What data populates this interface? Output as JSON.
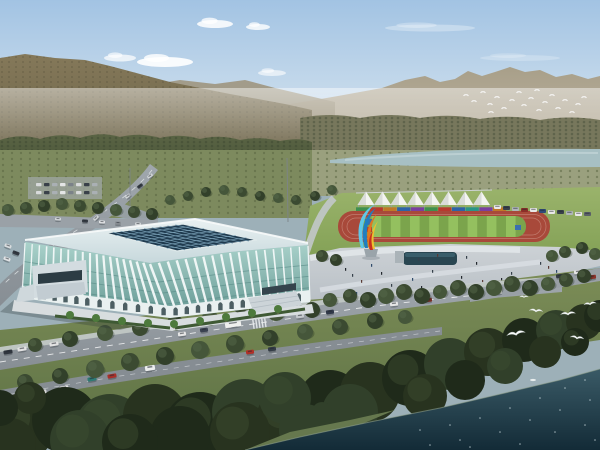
{
  "palette": {
    "sky_top": "#a2c3e3",
    "sky_mid": "#c9dcec",
    "sky_horizon": "#edf0ec",
    "cloud": "#ffffff",
    "far_mountain_top": "#a89f89",
    "far_mountain_bottom": "#beb5a3",
    "left_mountain_top": "#85795a",
    "left_mountain_bottom": "#6b6247",
    "ridge_mid": "#9f967f",
    "tree_belt_top": "#5a6444",
    "tree_belt_bottom": "#465136",
    "right_forest": "#77775c",
    "orchard_band": "#7d8a5e",
    "valley_band": "#9aa07e",
    "river": "#a7c0c4",
    "river_highlight": "#c3d6d8",
    "lawn_top": "#9ab36b",
    "lawn_bottom": "#82a055",
    "track_red": "#a8493a",
    "lane_line": "#c88a7c",
    "infield_base": "#7ba44c",
    "infield_stripe": "#94c05f",
    "mat_blue": "#3a6fb0",
    "mat_red": "#b83a2e",
    "tent_white": "#f3f4f1",
    "tent_shade": "#d9dcd8",
    "plaza_top": "#cdd2d6",
    "plaza_bottom": "#b7bec4",
    "pool_dark": "#294651",
    "pool_light": "#3d6472",
    "road_light": "#a0a7ad",
    "road_dark": "#878e94",
    "sidewalk": "#c7ccce",
    "lane_dash": "#eef0f1",
    "grass_top": "#7c8d57",
    "grass_bottom": "#5c7044",
    "roof_top": "#e9f1f2",
    "roof_bottom": "#c7d8dc",
    "roof_trim": "#f8fbfb",
    "skylight": "#1f3a4e",
    "skylight_grid": "#7fa6bc",
    "facade_glass_top": "#aad2cb",
    "facade_glass_bottom": "#649792",
    "facade_rib": "#f4f9f9",
    "facade_floor": "#5d8f8a",
    "arcade_band": "#e9f0f0",
    "arch_dark": "#31454a",
    "annex_grey": "#d3dce0",
    "annex_glass": "#2c3c44",
    "apron": "#d8dddf",
    "hedge": "#3f5a34",
    "palm": "#4d7a3c",
    "water_top": "#3a5a66",
    "water_bottom": "#132b37",
    "sparkle": "#d6e4e8",
    "bird_white": "#fafafa",
    "gull_white": "#f7f9f9",
    "sculpture_cyan": "#5fc8e8",
    "sculpture_blue": "#1f7ec0",
    "sculpture_orange": "#e07820",
    "sculpture_yellow": "#ecc030",
    "sculpture_red": "#c83020",
    "pedestal": "#9aa4aa",
    "tree_tones": [
      "#3b4a31",
      "#32402a",
      "#45563a"
    ],
    "fg_tree_tones": [
      "#28331f",
      "#1f2a1a",
      "#31402a"
    ],
    "ped_tones": [
      "#23282e",
      "#35404a",
      "#5a3a34",
      "#2e4a6a"
    ]
  },
  "scene": {
    "clouds": [
      [
        165,
        62,
        28,
        5,
        0.9
      ],
      [
        215,
        24,
        18,
        4,
        0.85
      ],
      [
        258,
        27,
        12,
        3,
        0.8
      ],
      [
        272,
        73,
        14,
        3,
        0.6
      ],
      [
        430,
        28,
        45,
        3.5,
        0.3
      ],
      [
        520,
        58,
        40,
        3,
        0.22
      ],
      [
        120,
        58,
        16,
        3.5,
        0.7
      ]
    ],
    "far_birds": [
      [
        466,
        95
      ],
      [
        474,
        101
      ],
      [
        483,
        92
      ],
      [
        490,
        104
      ],
      [
        497,
        97
      ],
      [
        504,
        108
      ],
      [
        512,
        100
      ],
      [
        519,
        92
      ],
      [
        524,
        105
      ],
      [
        531,
        98
      ],
      [
        539,
        110
      ],
      [
        545,
        102
      ],
      [
        552,
        95
      ],
      [
        558,
        108
      ],
      [
        565,
        100
      ],
      [
        572,
        112
      ],
      [
        578,
        104
      ],
      [
        584,
        97
      ],
      [
        491,
        112
      ],
      [
        537,
        90
      ]
    ],
    "gulls": [
      [
        516,
        334,
        15,
        -10
      ],
      [
        536,
        311,
        11,
        5
      ],
      [
        568,
        314,
        12,
        -5
      ],
      [
        577,
        338,
        11,
        8
      ],
      [
        590,
        304,
        10,
        -8
      ],
      [
        524,
        297,
        7,
        0
      ]
    ],
    "tents": {
      "x0": 366,
      "dx": 16.5,
      "n": 8,
      "apex": 191.5,
      "base": 205,
      "half": 8.5
    },
    "banner_panels": [
      "#3f8f4f",
      "#b8392e",
      "#c07828",
      "#2e62a8",
      "#7a3fa0",
      "#3f8f4f",
      "#b8392e",
      "#2e62a8",
      "#2a9488",
      "#7a3fa0",
      "#c07828"
    ],
    "track": {
      "outer": [
        338,
        211,
        212,
        31,
        15
      ],
      "infield": [
        362,
        216,
        164,
        21,
        10
      ],
      "stripe_w": 9.6,
      "stripe_n": 17
    },
    "parked_cars": [
      [
        494,
        205,
        "#e8e8e8"
      ],
      [
        503,
        206,
        "#38404a"
      ],
      [
        512,
        207,
        "#b0b6ba"
      ],
      [
        521,
        208,
        "#8a2f28"
      ],
      [
        530,
        208,
        "#e8e8e8"
      ],
      [
        539,
        209,
        "#2f4a78"
      ],
      [
        548,
        210,
        "#e8e8e8"
      ],
      [
        557,
        210,
        "#38404a"
      ],
      [
        566,
        211,
        "#b0b6ba"
      ],
      [
        575,
        212,
        "#e8e8e8"
      ],
      [
        584,
        212,
        "#5a6068"
      ]
    ],
    "cars": [
      [
        233,
        324,
        16,
        6,
        -8,
        "#f0f0ee"
      ],
      [
        182,
        334,
        8,
        4,
        -8,
        "#e6e6e6"
      ],
      [
        204,
        330,
        8,
        4,
        -8,
        "#3a4250"
      ],
      [
        300,
        316,
        8,
        4,
        -7,
        "#c4c8cc"
      ],
      [
        330,
        312,
        8,
        4,
        -7,
        "#303848"
      ],
      [
        394,
        304,
        8,
        4,
        -6,
        "#e6e6e6"
      ],
      [
        428,
        300,
        8,
        4,
        -6,
        "#7a2f28"
      ],
      [
        498,
        292,
        8,
        4,
        -6,
        "#e6e6e6"
      ],
      [
        8,
        352,
        9,
        4,
        -9,
        "#30363e"
      ],
      [
        22,
        349,
        9,
        4,
        -9,
        "#e2e2e2"
      ],
      [
        36,
        347,
        9,
        4,
        -9,
        "#9a3030"
      ],
      [
        54,
        344,
        9,
        4,
        -9,
        "#e2e2e2"
      ],
      [
        20,
        396,
        9,
        4,
        -10,
        "#e6e6e6"
      ],
      [
        42,
        392,
        9,
        4,
        -10,
        "#d8d8d8"
      ],
      [
        64,
        388,
        9,
        4,
        -10,
        "#e4e4e4"
      ],
      [
        92,
        379,
        9,
        4,
        -10,
        "#2e7a74"
      ],
      [
        112,
        376,
        9,
        4,
        -10,
        "#a8302a"
      ],
      [
        150,
        368,
        10,
        5,
        -9,
        "#eceeee"
      ],
      [
        250,
        352,
        8,
        4,
        -8,
        "#b03028"
      ],
      [
        272,
        349,
        8,
        4,
        -8,
        "#343c46"
      ],
      [
        560,
        276,
        8,
        4,
        -6,
        "#343a42"
      ],
      [
        578,
        272,
        8,
        4,
        -6,
        "#e4e4e4"
      ],
      [
        592,
        277,
        8,
        4,
        -6,
        "#8a2f28"
      ],
      [
        8,
        246,
        7,
        3.5,
        20,
        "#d8dcde"
      ],
      [
        16,
        253,
        7,
        3.5,
        20,
        "#343a42"
      ],
      [
        7,
        259,
        7,
        3.5,
        20,
        "#e0e2e4"
      ],
      [
        150,
        176,
        6,
        3,
        -35,
        "#d0d4d6"
      ],
      [
        140,
        186,
        6,
        3,
        -38,
        "#343a42"
      ],
      [
        128,
        196,
        6,
        3,
        -40,
        "#d0d4d6"
      ],
      [
        112,
        208,
        6,
        3,
        -42,
        "#8a8f94"
      ],
      [
        96,
        218,
        6,
        3,
        -44,
        "#d0d4d6"
      ],
      [
        58,
        219,
        6,
        3,
        2,
        "#d0d4d6"
      ],
      [
        85,
        221,
        6,
        3,
        2,
        "#343a42"
      ],
      [
        102,
        222,
        6,
        3,
        2,
        "#e0e2e4"
      ],
      [
        118,
        223,
        6,
        3,
        2,
        "#8a8f94"
      ],
      [
        138,
        224,
        6,
        3,
        2,
        "#d0d4d6"
      ]
    ],
    "parking_lot": {
      "x0": 36,
      "dx": 8,
      "rows": [
        183,
        191
      ],
      "n": 8,
      "colors": [
        "#d8dadb",
        "#394049",
        "#aab0b4",
        "#e4e6e6",
        "#7b8288"
      ]
    },
    "pedestrians": [
      [
        345,
        268
      ],
      [
        352,
        274
      ],
      [
        361,
        280
      ],
      [
        371,
        264
      ],
      [
        381,
        272
      ],
      [
        391,
        284
      ],
      [
        401,
        290
      ],
      [
        412,
        278
      ],
      [
        421,
        286
      ],
      [
        432,
        270
      ],
      [
        441,
        292
      ],
      [
        452,
        284
      ],
      [
        461,
        276
      ],
      [
        471,
        290
      ],
      [
        482,
        280
      ],
      [
        492,
        286
      ],
      [
        501,
        278
      ],
      [
        511,
        272
      ],
      [
        521,
        284
      ],
      [
        531,
        290
      ],
      [
        476,
        262
      ],
      [
        466,
        256
      ],
      [
        372,
        296
      ],
      [
        356,
        292
      ],
      [
        262,
        300
      ],
      [
        268,
        304
      ],
      [
        274,
        308
      ],
      [
        282,
        296
      ],
      [
        252,
        306
      ],
      [
        540,
        262
      ],
      [
        548,
        266
      ],
      [
        556,
        270
      ],
      [
        336,
        262
      ],
      [
        418,
        258
      ],
      [
        437,
        254
      ]
    ],
    "street_trees": [
      [
        25,
        382,
        8
      ],
      [
        60,
        376,
        8
      ],
      [
        95,
        369,
        9
      ],
      [
        130,
        362,
        9
      ],
      [
        165,
        356,
        9
      ],
      [
        200,
        350,
        9
      ],
      [
        235,
        344,
        9
      ],
      [
        270,
        338,
        8
      ],
      [
        305,
        332,
        8
      ],
      [
        340,
        327,
        8
      ],
      [
        375,
        321,
        8
      ],
      [
        405,
        317,
        7
      ],
      [
        35,
        345,
        7
      ],
      [
        70,
        339,
        8
      ],
      [
        105,
        333,
        8
      ],
      [
        140,
        328,
        8
      ],
      [
        175,
        323,
        8
      ],
      [
        210,
        318,
        8
      ],
      [
        240,
        305,
        8
      ],
      [
        258,
        309,
        9
      ],
      [
        276,
        312,
        9
      ],
      [
        294,
        307,
        8
      ],
      [
        312,
        310,
        8
      ],
      [
        330,
        300,
        7
      ],
      [
        350,
        296,
        7
      ],
      [
        368,
        300,
        8
      ],
      [
        386,
        296,
        8
      ],
      [
        404,
        292,
        8
      ],
      [
        422,
        296,
        8
      ],
      [
        440,
        292,
        7
      ],
      [
        458,
        288,
        8
      ],
      [
        476,
        292,
        8
      ],
      [
        494,
        288,
        8
      ],
      [
        512,
        284,
        8
      ],
      [
        530,
        288,
        8
      ],
      [
        548,
        284,
        7
      ],
      [
        566,
        280,
        7
      ],
      [
        584,
        276,
        7
      ],
      [
        552,
        256,
        6
      ],
      [
        565,
        252,
        6
      ],
      [
        582,
        248,
        6
      ],
      [
        595,
        254,
        6
      ],
      [
        322,
        256,
        6
      ],
      [
        336,
        260,
        6
      ],
      [
        8,
        210,
        6
      ],
      [
        26,
        208,
        6
      ],
      [
        44,
        206,
        6
      ],
      [
        62,
        204,
        6
      ],
      [
        80,
        206,
        6
      ],
      [
        98,
        208,
        6
      ],
      [
        116,
        210,
        6
      ],
      [
        134,
        212,
        6
      ],
      [
        152,
        214,
        6
      ],
      [
        170,
        200,
        5
      ],
      [
        188,
        196,
        5
      ],
      [
        206,
        192,
        5
      ],
      [
        224,
        190,
        5
      ],
      [
        242,
        192,
        5
      ],
      [
        260,
        196,
        5
      ],
      [
        278,
        198,
        5
      ],
      [
        296,
        200,
        5
      ],
      [
        315,
        196,
        5
      ],
      [
        332,
        190,
        5
      ]
    ],
    "fg_trees": [
      [
        20,
        428,
        34
      ],
      [
        65,
        420,
        33
      ],
      [
        110,
        430,
        36
      ],
      [
        155,
        416,
        32
      ],
      [
        200,
        428,
        36
      ],
      [
        245,
        412,
        33
      ],
      [
        290,
        420,
        34
      ],
      [
        330,
        402,
        32
      ],
      [
        285,
        398,
        26
      ],
      [
        370,
        392,
        30
      ],
      [
        410,
        378,
        28
      ],
      [
        450,
        364,
        26
      ],
      [
        488,
        352,
        24
      ],
      [
        524,
        340,
        22
      ],
      [
        556,
        330,
        20
      ],
      [
        584,
        322,
        18
      ],
      [
        600,
        316,
        16
      ],
      [
        350,
        412,
        28
      ],
      [
        240,
        432,
        30
      ],
      [
        180,
        436,
        30
      ],
      [
        80,
        440,
        30
      ],
      [
        10,
        444,
        26
      ],
      [
        130,
        442,
        28
      ],
      [
        305,
        430,
        26
      ],
      [
        425,
        396,
        22
      ],
      [
        465,
        380,
        20
      ],
      [
        505,
        366,
        18
      ],
      [
        545,
        352,
        16
      ],
      [
        575,
        342,
        14
      ],
      [
        322,
        412,
        10
      ],
      [
        30,
        398,
        16
      ],
      [
        0,
        408,
        18
      ]
    ],
    "sparkles": [
      [
        420,
        430
      ],
      [
        450,
        425
      ],
      [
        480,
        418
      ],
      [
        510,
        408
      ],
      [
        540,
        398
      ],
      [
        565,
        388
      ],
      [
        585,
        380
      ],
      [
        460,
        440
      ],
      [
        500,
        432
      ],
      [
        530,
        420
      ],
      [
        560,
        410
      ],
      [
        590,
        400
      ],
      [
        430,
        445
      ],
      [
        470,
        447
      ],
      [
        555,
        432
      ],
      [
        585,
        425
      ],
      [
        595,
        440
      ],
      [
        520,
        444
      ]
    ],
    "facade": {
      "ribs": 36,
      "arches": 24,
      "floors": [
        0.35,
        0.55,
        0.75
      ]
    },
    "skylight_grid": {
      "cols": 10,
      "rows": 7
    },
    "boat": [
      533,
      380
    ]
  }
}
